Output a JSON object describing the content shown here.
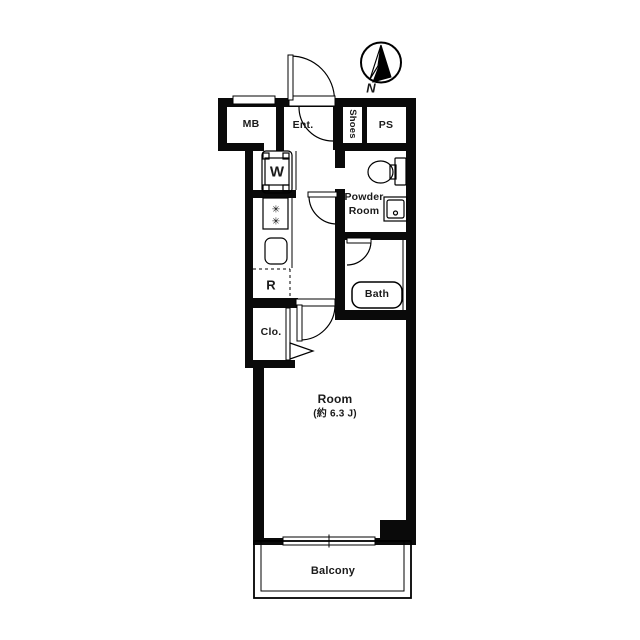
{
  "title": "Apartment floor plan",
  "compass": {
    "label": "N"
  },
  "rooms": {
    "mb": {
      "label": "MB"
    },
    "entrance": {
      "label": "Ent."
    },
    "shoes": {
      "label": "Shoes"
    },
    "ps": {
      "label": "PS"
    },
    "powder": {
      "line1": "Powder",
      "line2": "Room"
    },
    "bath": {
      "label": "Bath"
    },
    "washer": {
      "label": "W"
    },
    "refrigerator": {
      "label": "R"
    },
    "closet": {
      "label": "Clo."
    },
    "main": {
      "label": "Room",
      "size": "(約 6.3 J)"
    },
    "balcony": {
      "label": "Balcony"
    }
  },
  "icons": {
    "burner": "✳"
  },
  "colors": {
    "wall": "#0a0a0a",
    "background": "#ffffff",
    "line": "#000000"
  }
}
